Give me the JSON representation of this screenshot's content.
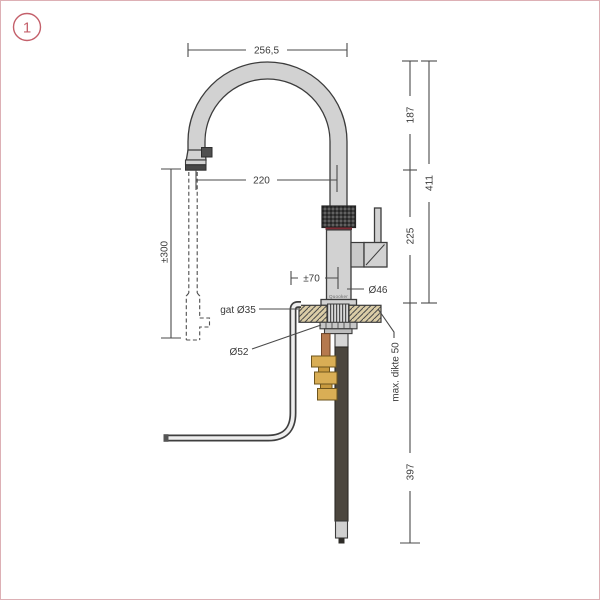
{
  "figure": {
    "badge": "1"
  },
  "drawing": {
    "brand": "Quooker",
    "labels": {
      "top_width": "256,5",
      "spout_reach": "220",
      "hose_pullout": "±300",
      "upper_height": "187",
      "total_height": "411",
      "lower_height": "225",
      "handle_offset": "±70",
      "body_diameter": "Ø46",
      "hole_diameter": "gat Ø35",
      "base_diameter": "Ø52",
      "max_thickness": "max. dikte 50",
      "under_counter": "397"
    },
    "colors": {
      "accent_pink": "#c4606b",
      "frame_border": "#ddb0b5",
      "line": "#3c3c3c",
      "metal_gray": "#d2d2d2",
      "knurl_dark": "#3d3d3d",
      "seal_red": "#7c2a33",
      "counter_tan": "#dbcda7",
      "brass": "#d9ae55",
      "copper": "#b5794e",
      "tube_dark": "#4b463e"
    }
  }
}
